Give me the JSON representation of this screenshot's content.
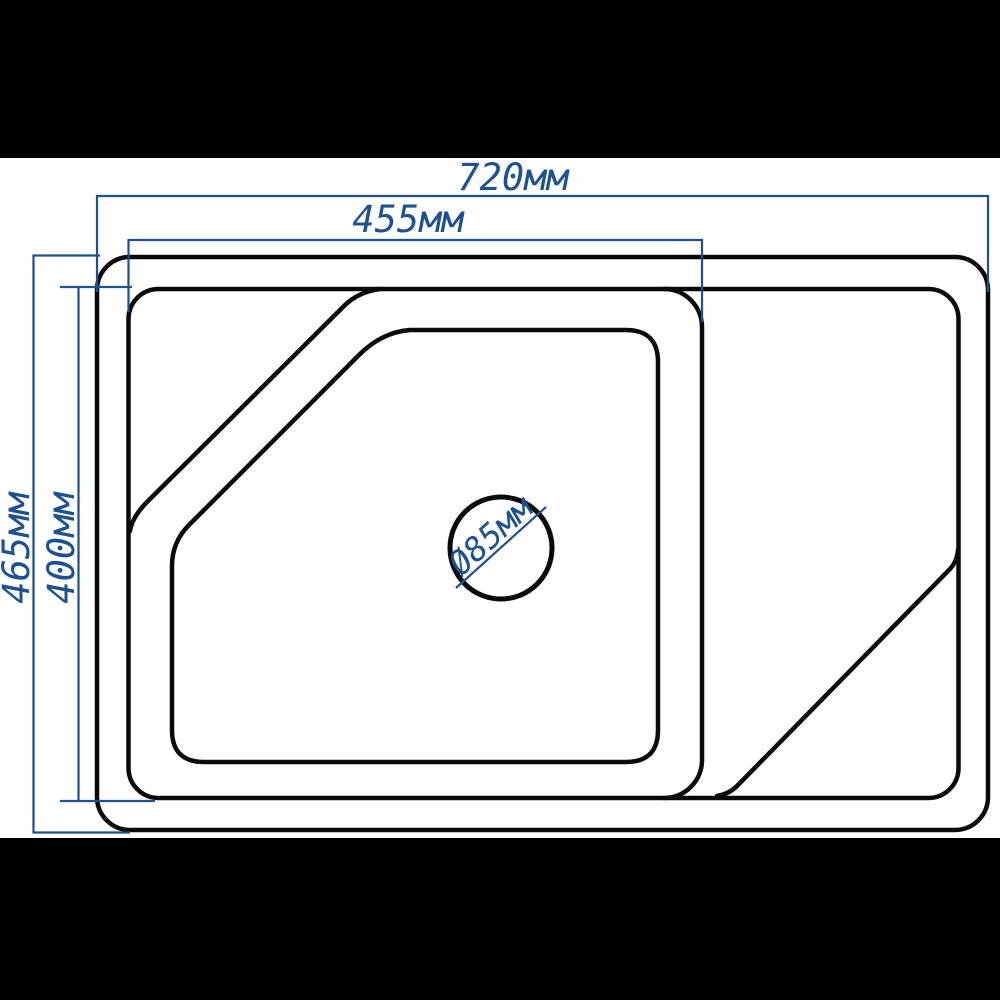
{
  "page": {
    "background": "#ffffff",
    "letterbox_color": "#000000"
  },
  "drawing": {
    "type": "kitchen-sink-dimension-diagram",
    "colors": {
      "outline": "#0a0a0a",
      "dimension": "#1e5191"
    },
    "dimensions": {
      "overall_width": {
        "label": "720мм",
        "value_mm": 720
      },
      "bowl_width": {
        "label": "455мм",
        "value_mm": 455
      },
      "overall_depth": {
        "label": "465мм",
        "value_mm": 465
      },
      "bowl_depth": {
        "label": "400мм",
        "value_mm": 400
      },
      "drain_diameter": {
        "label": "Ø85мм",
        "value_mm": 85
      }
    }
  }
}
